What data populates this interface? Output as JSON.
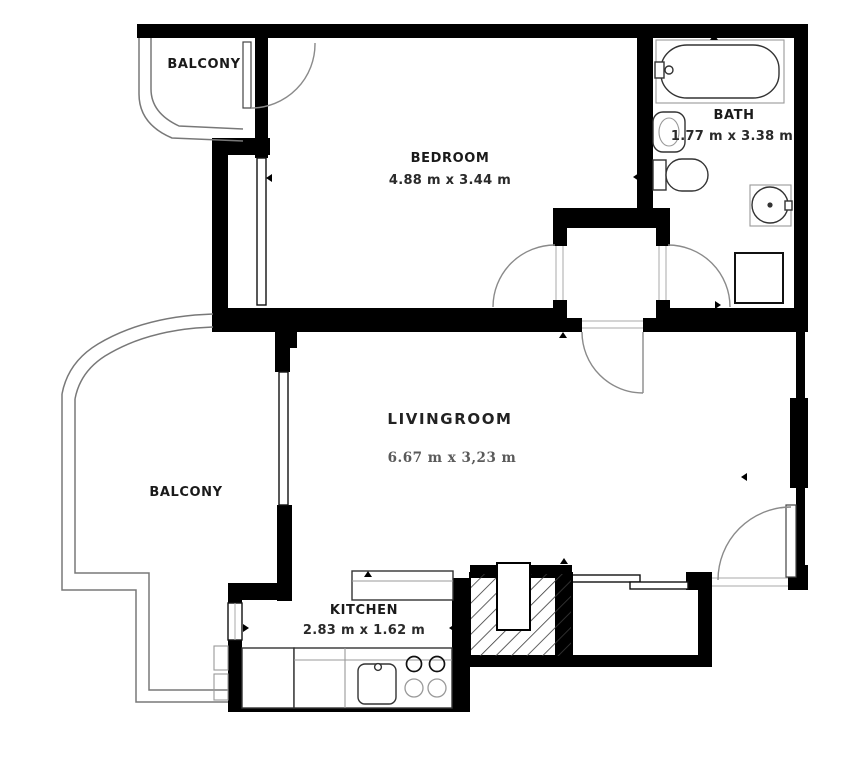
{
  "title": "Apartment floor plan",
  "colors": {
    "background": "#ffffff",
    "walls": "#000000",
    "fixtures": "#333333",
    "railing": "#787878",
    "label_text": "#1a1a1a",
    "livingroom_dim_text": "#5a5a5a"
  },
  "rooms": {
    "balcony_top": {
      "label": "BALCONY"
    },
    "bedroom": {
      "label": "BEDROOM",
      "dimensions": "4.88 m x 3.44 m"
    },
    "bath": {
      "label": "BATH",
      "dimensions": "1.77 m x 3.38 m"
    },
    "livingroom": {
      "label": "LIVINGROOM",
      "dimensions": "6.67 m x 3,23 m"
    },
    "balcony_left": {
      "label": "BALCONY"
    },
    "kitchen": {
      "label": "KITCHEN",
      "dimensions": "2.83 m x 1.62 m"
    }
  }
}
